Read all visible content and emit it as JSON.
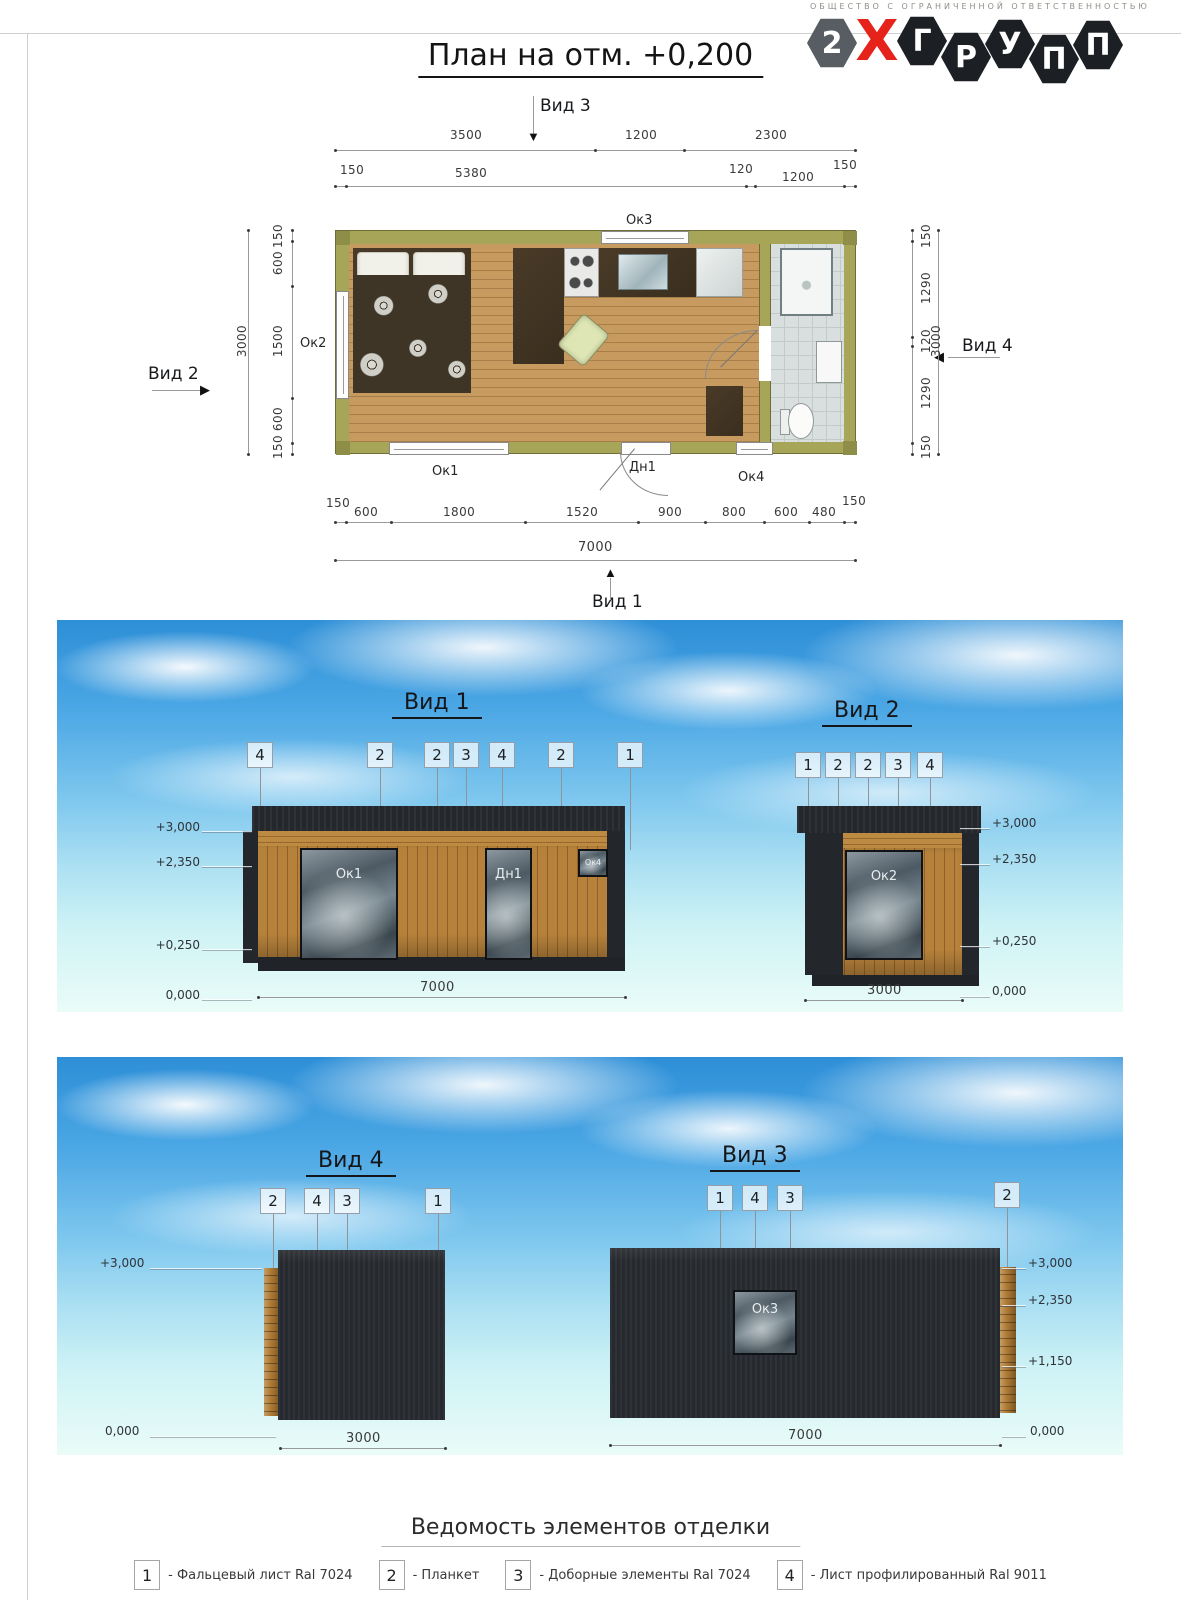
{
  "company": {
    "tagline": "ОБЩЕСТВО С ОГРАНИЧЕННОЙ ОТВЕТСТВЕННОСТЬЮ",
    "logo_letters": [
      "2",
      "Х",
      "Г",
      "Р",
      "У",
      "П",
      "П"
    ]
  },
  "sheet": {
    "title": "План на отм. +0,200"
  },
  "plan": {
    "views": {
      "v1": "Вид 1",
      "v2": "Вид 2",
      "v3": "Вид 3",
      "v4": "Вид 4"
    },
    "dims_top1": [
      "3500",
      "1200",
      "2300"
    ],
    "dims_top2": [
      "150",
      "5380",
      "120",
      "1200",
      "150"
    ],
    "dims_left": [
      "150",
      "600",
      "1500",
      "600",
      "150"
    ],
    "dims_left_total": "3000",
    "dims_right": [
      "150",
      "1290",
      "120",
      "1290",
      "150"
    ],
    "dims_right_total": "3000",
    "dims_bottom": [
      "150",
      "600",
      "1800",
      "1520",
      "900",
      "800",
      "600",
      "480",
      "150"
    ],
    "dims_bottom_total": "7000",
    "openings": {
      "ok1": "Ок1",
      "ok2": "Ок2",
      "ok3": "Ок3",
      "ok4": "Ок4",
      "dn1": "Дн1",
      "dv1": "Дв1"
    },
    "areas": {
      "living": "14,53",
      "bath": "3,24"
    }
  },
  "elevations": {
    "view1": {
      "title": "Вид 1",
      "callouts": [
        "4",
        "2",
        "2",
        "3",
        "4",
        "2",
        "1"
      ],
      "marks": [
        "+3,000",
        "+2,350",
        "+0,250",
        "0,000"
      ],
      "width": "7000"
    },
    "view2": {
      "title": "Вид 2",
      "callouts": [
        "1",
        "2",
        "2",
        "3",
        "4"
      ],
      "marks": [
        "+3,000",
        "+2,350",
        "+0,250",
        "0,000"
      ],
      "width": "3000"
    },
    "view4": {
      "title": "Вид 4",
      "callouts": [
        "2",
        "4",
        "3",
        "1"
      ],
      "marks": [
        "+3,000",
        "0,000"
      ],
      "width": "3000"
    },
    "view3": {
      "title": "Вид 3",
      "callouts": [
        "1",
        "4",
        "3",
        "2"
      ],
      "marks": [
        "+3,000",
        "+2,350",
        "+1,150",
        "0,000"
      ],
      "width": "7000"
    }
  },
  "legend": {
    "title": "Ведомость элементов отделки",
    "items": [
      {
        "num": "1",
        "label": "- Фальцевый лист Ral 7024"
      },
      {
        "num": "2",
        "label": "- Планкет"
      },
      {
        "num": "3",
        "label": "- Доборные элементы Ral 7024"
      },
      {
        "num": "4",
        "label": "- Лист профилированный Ral 9011"
      }
    ]
  },
  "colors": {
    "logo_red": "#e5231b",
    "wall_olive": "#a7a557",
    "wood_floor": "#c79a60",
    "facade_dark": "#26292d",
    "facade_wood": "#b5813b",
    "sky_top": "#2e8fd7"
  }
}
